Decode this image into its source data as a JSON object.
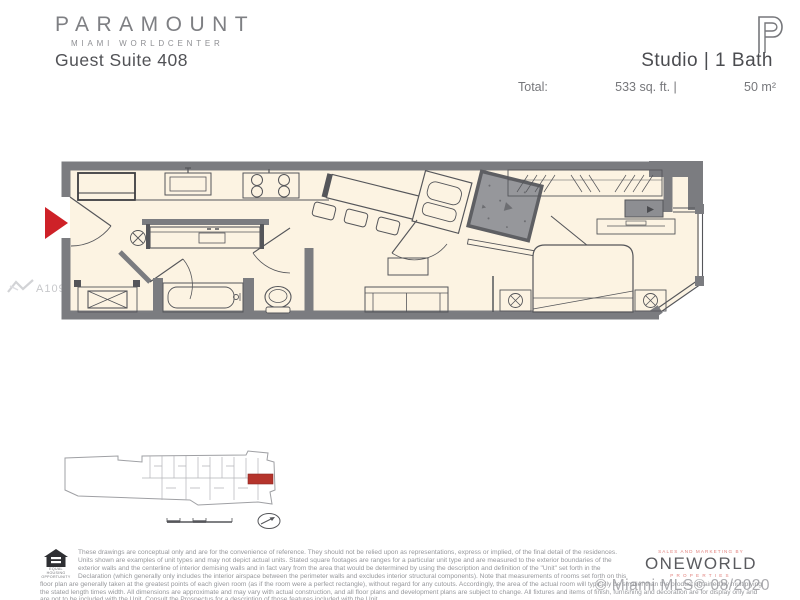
{
  "header": {
    "brand": "PARAMOUNT",
    "brand_sub": "MIAMI  WORLDCENTER",
    "unit_title": "Guest Suite 408",
    "unit_type": "Studio  |  1 Bath",
    "total_label": "Total:",
    "total_sqft": "533 sq. ft. |",
    "total_m2": "50 m²",
    "logo_icon": "paramount-p-logo"
  },
  "floorplan": {
    "features": [
      "entry-arrow",
      "entry-door",
      "refrigerator",
      "kitchen-sink",
      "cooktop",
      "breakfast-bar",
      "bar-stools",
      "appliance-cabinet",
      "concrete-column",
      "bathroom-vanity",
      "washer-dryer",
      "bathtub",
      "toilet",
      "interior-doors",
      "sofa",
      "coffee-table",
      "curtain-partition",
      "bed",
      "nightstand-left",
      "nightstand-right",
      "closet-hatch",
      "tv-console",
      "console-table",
      "windows"
    ],
    "entry_arrow_color": "#ce2128",
    "floor_color": "#fcf3e2",
    "wall_color": "#7b7c80"
  },
  "keyplan": {
    "features": [
      "building-footprint",
      "unit-highlight",
      "scale-bar",
      "north-arrow"
    ],
    "highlight_color": "#b5342c"
  },
  "watermarks": {
    "mls_number": "A10902124",
    "bottom_right": "© Miami MLS© 08/2020"
  },
  "footer": {
    "equal_housing_line1": "EQUAL HOUSING",
    "equal_housing_line2": "OPPORTUNITY",
    "disclaimer": "These drawings are conceptual only and are for the convenience of reference. They should not be relied upon as representations, express or implied, of the final detail of the residences. Units shown are examples of unit types and may not depict actual units. Stated square footages are ranges for a particular unit type and are measured to the exterior boundaries of the exterior walls and the centerline of interior demising walls and in fact vary from the area that would be determined by using the description and definition of the \"Unit\" set forth in the Declaration (which generally only includes the interior airspace between the perimeter walls and excludes interior structural components). Note that measurements of rooms set forth on this floor plan are generally taken at the greatest points of each given room (as if the room were a perfect rectangle), without regard for any cutouts. Accordingly, the area of the actual room will typically be smaller than the product obtained by multiplying the stated length times width. All dimensions are approximate and may vary with actual construction, and all floor plans and development plans are subject to change. All fixtures and items of finish, furnishing and decoration are for display only and are not to be included with the Unit. Consult the Prospectus for a description of those features included with the Unit.",
    "marketing_tagline": "SALES AND MARKETING BY",
    "company": "ONEWORLD",
    "company_sub": "PROPERTIES"
  }
}
